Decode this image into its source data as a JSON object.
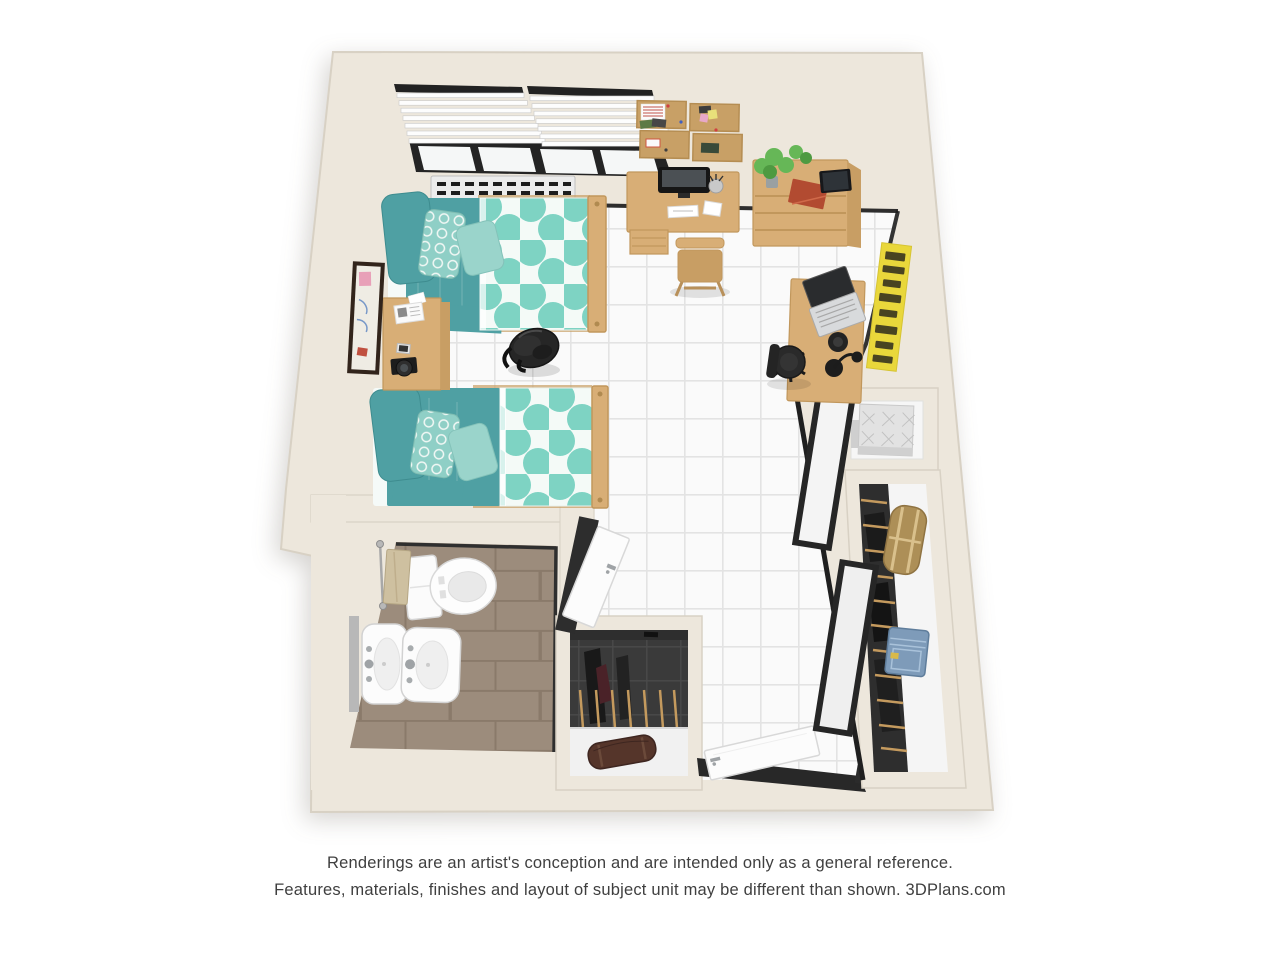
{
  "caption": {
    "line1": "Renderings are an artist's conception and are intended only as a general reference.",
    "line2": "Features, materials, finishes and layout of subject unit may be different than shown. 3DPlans.com"
  },
  "scene": {
    "type": "3d-floor-plan-rendering",
    "rooms": [
      "studio bedroom",
      "bathroom",
      "entry",
      "closets"
    ],
    "furniture": [
      "twin-bed-1",
      "twin-bed-2",
      "teal-pillows",
      "patterned-duvets",
      "nightstand",
      "wall-picture-frame",
      "window-with-blinds",
      "radiator",
      "cork-boards",
      "study-desk-with-monitor",
      "desk-chair",
      "dresser-with-plant-book-tablet",
      "laptop-desk",
      "office-chair",
      "yellow-wall-poster",
      "backpack",
      "blanket-cubby",
      "wardrobe-with-hanging-clothes",
      "tan-duffel",
      "denim-bag",
      "sliding-closet-doors",
      "entry-door",
      "shoe-closet-with-brown-duffel",
      "toilet",
      "double-pedestal-sinks",
      "towel-bar",
      "bathroom-door"
    ]
  },
  "colors": {
    "page_bg": "#FFFFFF",
    "caption": "#3F3F3F",
    "wall": "#EDE7DC",
    "wall_edge": "#D8D1C4",
    "floor": "#FAFAFA",
    "floor_grid": "#E3E3E3",
    "bath_tile": "#9C8C7C",
    "bath_tile_grid": "#8A7A6A",
    "wood": "#D8AE76",
    "wood_dark": "#C1975C",
    "wood_side": "#C89E64",
    "teal": "#4FA0A3",
    "teal_dark": "#3E8C8F",
    "aqua": "#7ED3C3",
    "aqua_bg": "#F4FAF7",
    "aqua_mid": "#8FCFC6",
    "aqua_light": "#9AD4CB",
    "charcoal": "#3A3A3A",
    "charcoal_grid": "#4A4A4A",
    "ink": "#222222",
    "white": "#FDFDFD",
    "chrome": "#9FA3A6",
    "poster_yellow": "#E9D73B",
    "poster_ink": "#33301E",
    "plant": "#66B757",
    "plant_dark": "#4E9A41",
    "book_red": "#B24B31",
    "towel": "#CEC0A0",
    "cork": "#C8A066",
    "cork_dark": "#B58D52",
    "duffel_tan": "#AD8F57",
    "denim": "#7E9BB9",
    "bag_brown": "#55352A"
  }
}
